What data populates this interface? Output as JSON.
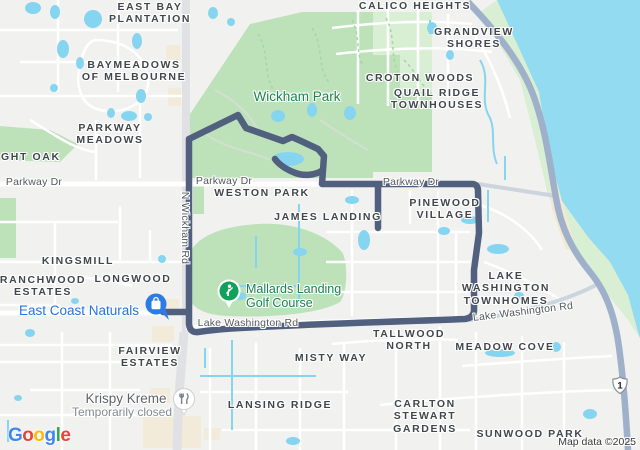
{
  "theme": {
    "land": "#f1f1ef",
    "water": "#92dbf0",
    "park": "#bde2ba",
    "parkLight": "#d9efd3",
    "pond": "#86d5f0",
    "road": "#ffffff",
    "roadGray": "#dfe1e5",
    "roadBlueGray": "#ccd4de",
    "highway": "#9fb0ca",
    "route": "#51607e",
    "building": "#f2ebd9",
    "sand": "#f2e9d2",
    "trail": "#a4d6a4",
    "parkPath": "#d3dfd0"
  },
  "map": {
    "attribution": "Map data ©2025",
    "shield": {
      "route_number": "1"
    },
    "route": {
      "color": "#51607e",
      "kind": "driving-route-loop"
    },
    "logo_letters": [
      {
        "ch": "G",
        "color": "#4285F4"
      },
      {
        "ch": "o",
        "color": "#EA4335"
      },
      {
        "ch": "o",
        "color": "#FBBC05"
      },
      {
        "ch": "g",
        "color": "#4285F4"
      },
      {
        "ch": "l",
        "color": "#34A853"
      },
      {
        "ch": "e",
        "color": "#EA4335"
      }
    ],
    "pins": [
      {
        "id": "east-coast-naturals-pin",
        "business": "East Coast Naturals",
        "icon": "shopping-bag-icon"
      },
      {
        "id": "mallards-golf-pin",
        "business": "Mallards Landing Golf Course",
        "icon": "golfer-icon"
      },
      {
        "id": "krispy-kreme-pin",
        "business": "Krispy Kreme",
        "icon": "fork-knife-icon"
      }
    ],
    "labels": [
      {
        "id": "label-east-bay-plantation",
        "cls": "hood",
        "x": 150,
        "y": 1,
        "lines": [
          "EAST BAY",
          "PLANTATION"
        ],
        "inter": false
      },
      {
        "id": "label-calico-heights",
        "cls": "hood",
        "x": 415,
        "y": 0,
        "lines": [
          "CALICO HEIGHTS"
        ],
        "inter": false
      },
      {
        "id": "label-grandview-shores",
        "cls": "hood",
        "x": 474,
        "y": 26,
        "lines": [
          "GRANDVIEW",
          "SHORES"
        ],
        "inter": false
      },
      {
        "id": "label-baymeadows-of-melbourne",
        "cls": "hood",
        "x": 134,
        "y": 59,
        "lines": [
          "BAYMEADOWS",
          "OF MELBOURNE"
        ],
        "inter": false
      },
      {
        "id": "label-croton-woods",
        "cls": "hood",
        "x": 420,
        "y": 72,
        "lines": [
          "CROTON WOODS"
        ],
        "inter": false
      },
      {
        "id": "label-quail-ridge-townhouses",
        "cls": "hood",
        "x": 437,
        "y": 87,
        "lines": [
          "QUAIL RIDGE",
          "TOWNHOUSES"
        ],
        "inter": false
      },
      {
        "id": "label-parkway-meadows",
        "cls": "hood",
        "x": 110,
        "y": 122,
        "lines": [
          "PARKWAY",
          "MEADOWS"
        ],
        "inter": false
      },
      {
        "id": "label-night-oak",
        "cls": "hood",
        "x": 24,
        "y": 151,
        "lines": [
          "NIGHT OAK"
        ],
        "inter": false
      },
      {
        "id": "label-wickham-park",
        "cls": "park-name",
        "x": 297,
        "y": 89,
        "lines": [
          "Wickham Park"
        ],
        "inter": true
      },
      {
        "id": "label-weston-park",
        "cls": "hood",
        "x": 262,
        "y": 187,
        "lines": [
          "WESTON PARK"
        ],
        "inter": false
      },
      {
        "id": "label-james-landing",
        "cls": "hood",
        "x": 328,
        "y": 211,
        "lines": [
          "JAMES LANDING"
        ],
        "inter": false
      },
      {
        "id": "label-pinewood-village",
        "cls": "hood",
        "x": 445,
        "y": 197,
        "lines": [
          "PINEWOOD",
          "VILLAGE"
        ],
        "inter": false
      },
      {
        "id": "label-kingsmill",
        "cls": "hood",
        "x": 78,
        "y": 255,
        "lines": [
          "KINGSMILL"
        ],
        "inter": false
      },
      {
        "id": "label-ranchwood-estates",
        "cls": "hood",
        "x": 43,
        "y": 274,
        "lines": [
          "RANCHWOOD",
          "ESTATES"
        ],
        "inter": false
      },
      {
        "id": "label-longwood",
        "cls": "hood",
        "x": 133,
        "y": 273,
        "lines": [
          "LONGWOOD"
        ],
        "inter": false
      },
      {
        "id": "label-east-coast-naturals",
        "cls": "poi-blue",
        "x": 79,
        "y": 303,
        "lines": [
          "East Coast Naturals"
        ],
        "inter": true
      },
      {
        "id": "label-mallards-landing-golf-course",
        "cls": "poi-green",
        "x": 246,
        "y": 282,
        "lines": [
          "Mallards Landing",
          "Golf Course"
        ],
        "anchor": "left",
        "inter": true
      },
      {
        "id": "label-lake-washington-townhomes",
        "cls": "hood",
        "x": 506,
        "y": 270,
        "lines": [
          "LAKE",
          "WASHINGTON",
          "TOWNHOMES"
        ],
        "inter": false
      },
      {
        "id": "label-tallwood-north",
        "cls": "hood",
        "x": 409,
        "y": 328,
        "lines": [
          "TALLWOOD",
          "NORTH"
        ],
        "inter": false
      },
      {
        "id": "label-meadow-cove",
        "cls": "hood",
        "x": 505,
        "y": 341,
        "lines": [
          "MEADOW COVE"
        ],
        "inter": false
      },
      {
        "id": "label-fairview-estates",
        "cls": "hood",
        "x": 150,
        "y": 345,
        "lines": [
          "FAIRVIEW",
          "ESTATES"
        ],
        "inter": false
      },
      {
        "id": "label-misty-way",
        "cls": "hood",
        "x": 331,
        "y": 352,
        "lines": [
          "MISTY WAY"
        ],
        "inter": false
      },
      {
        "id": "label-krispy-kreme",
        "cls": "poi-gray",
        "x": 126,
        "y": 391,
        "lines": [
          "Krispy Kreme"
        ],
        "inter": true
      },
      {
        "id": "label-krispy-kreme-closed",
        "cls": "note",
        "x": 122,
        "y": 405,
        "lines": [
          "Temporarily closed"
        ],
        "inter": false
      },
      {
        "id": "label-lansing-ridge",
        "cls": "hood",
        "x": 280,
        "y": 399,
        "lines": [
          "LANSING RIDGE"
        ],
        "inter": false
      },
      {
        "id": "label-carlton-stewart-gardens",
        "cls": "hood",
        "x": 425,
        "y": 398,
        "lines": [
          "CARLTON",
          "STEWART",
          "GARDENS"
        ],
        "inter": false
      },
      {
        "id": "label-sunwood-park",
        "cls": "hood",
        "x": 530,
        "y": 428,
        "lines": [
          "SUNWOOD PARK"
        ],
        "inter": false
      },
      {
        "id": "label-parkway-dr-west",
        "cls": "road-label",
        "x": 34,
        "y": 176,
        "lines": [
          "Parkway Dr"
        ],
        "inter": false
      },
      {
        "id": "label-parkway-dr-mid",
        "cls": "road-label",
        "x": 224,
        "y": 175,
        "lines": [
          "Parkway Dr"
        ],
        "inter": false
      },
      {
        "id": "label-parkway-dr-east",
        "cls": "road-label",
        "x": 411,
        "y": 176,
        "lines": [
          "Parkway Dr"
        ],
        "inter": false
      },
      {
        "id": "label-n-wickham-rd",
        "cls": "road-label",
        "x": 185,
        "y": 228,
        "lines": [
          "N Wickham Rd"
        ],
        "rot": 90,
        "inter": false
      },
      {
        "id": "label-lake-washington-rd-west",
        "cls": "road-label",
        "x": 248,
        "y": 317,
        "lines": [
          "Lake Washington Rd"
        ],
        "inter": false
      },
      {
        "id": "label-lake-washington-rd-east",
        "cls": "road-label",
        "x": 523,
        "y": 312,
        "lines": [
          "Lake Washington Rd"
        ],
        "rot": -7,
        "inter": false
      }
    ]
  }
}
